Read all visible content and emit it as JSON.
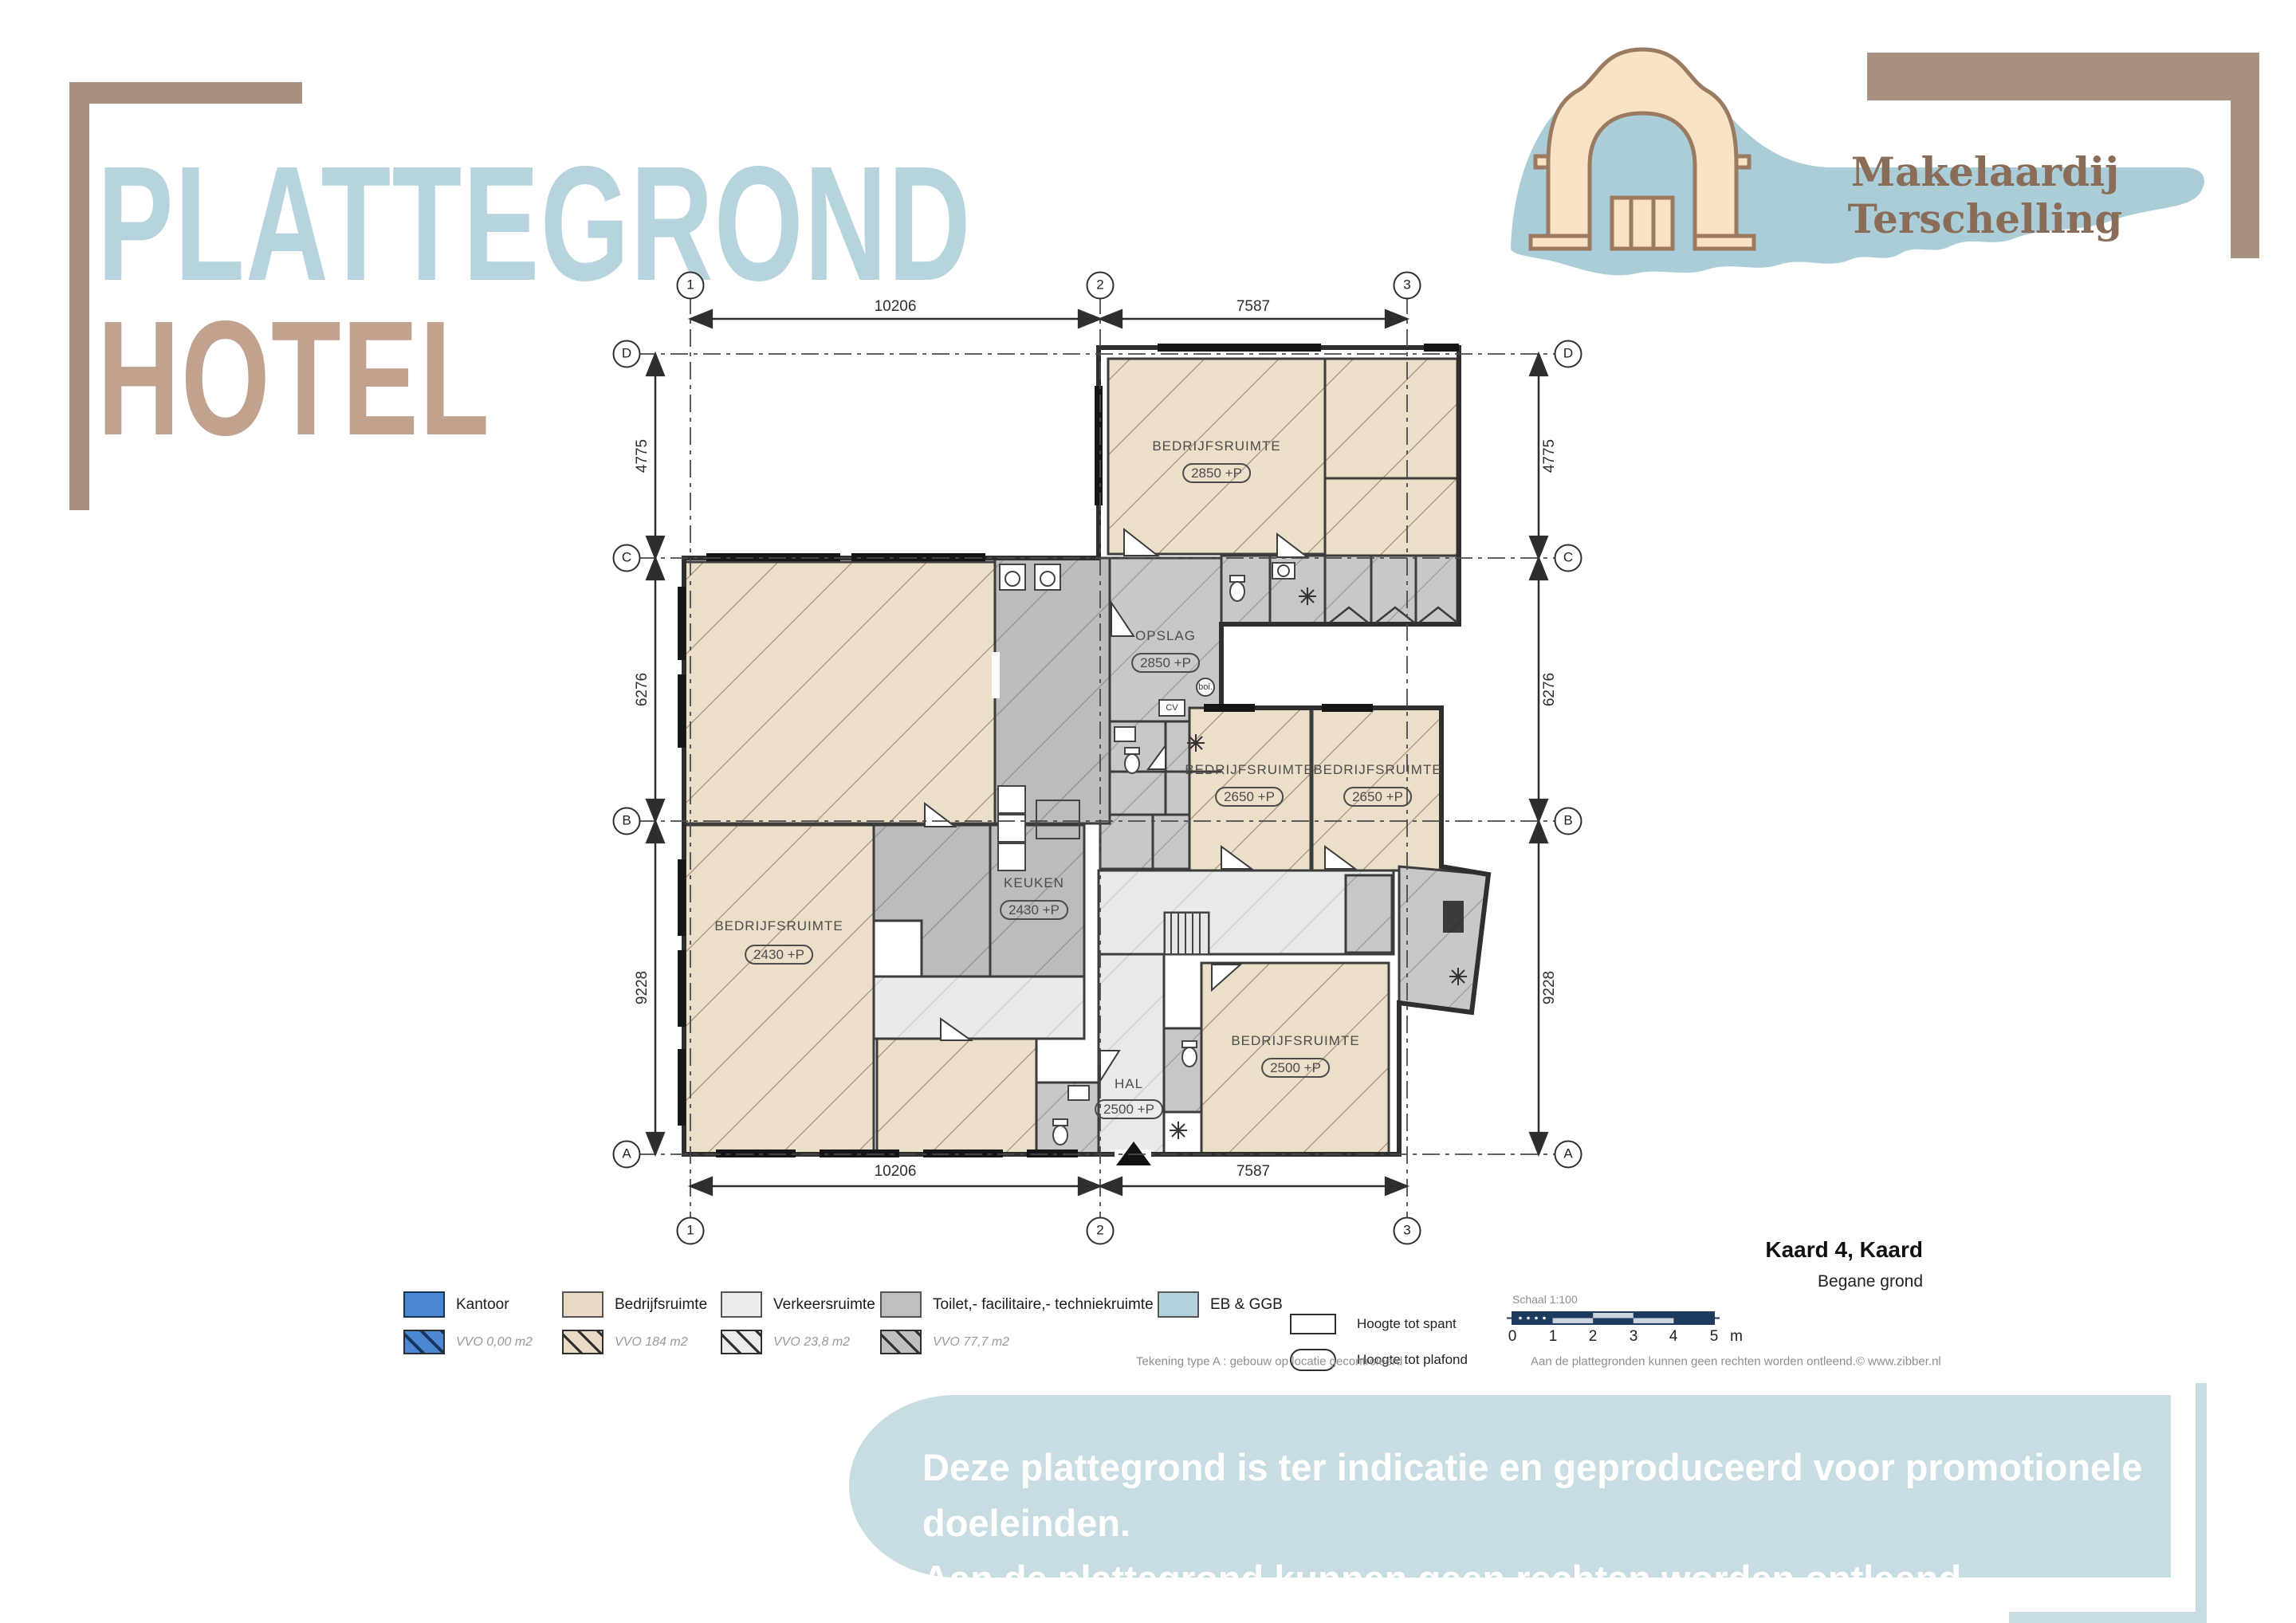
{
  "title": {
    "line1": "PLATTEGROND",
    "line2": "HOTEL"
  },
  "logo": {
    "name": "Makelaardij Terschelling"
  },
  "plan": {
    "grid": {
      "cols": [
        "1",
        "2",
        "3"
      ],
      "rows": [
        "D",
        "C",
        "B",
        "A"
      ]
    },
    "dims": {
      "top": [
        "10206",
        "7587"
      ],
      "bottom": [
        "10206",
        "7587"
      ],
      "left": [
        "4775",
        "6276",
        "9228"
      ],
      "right": [
        "4775",
        "6276",
        "9228"
      ]
    },
    "rooms": [
      {
        "name": "BEDRIJFSRUIMTE",
        "badge": "2850 +P"
      },
      {
        "name": "OPSLAG",
        "badge": "2850 +P"
      },
      {
        "name": "BEDRIJFSRUIMTE",
        "badge": "2650 +P"
      },
      {
        "name": "BEDRIJFSRUIMTE",
        "badge": "2650 +P"
      },
      {
        "name": "BEDRIJFSRUIMTE",
        "badge": "2430 +P"
      },
      {
        "name": "KEUKEN",
        "badge": "2430 +P"
      },
      {
        "name": "HAL",
        "badge": "2500 +P"
      },
      {
        "name": "BEDRIJFSRUIMTE",
        "badge": "2500 +P"
      }
    ],
    "fixtures": {
      "cv": "CV",
      "boiler": "boi."
    }
  },
  "legend": {
    "items": [
      {
        "label": "Kantoor",
        "vvo": "VVO 0,00 m2"
      },
      {
        "label": "Bedrijfsruimte",
        "vvo": "VVO 184 m2"
      },
      {
        "label": "Verkeersruimte",
        "vvo": "VVO 23,8 m2"
      },
      {
        "label": "Toilet,- facilitaire,- techniekruimte",
        "vvo": "VVO 77,7 m2"
      },
      {
        "label": "EB & GGB"
      }
    ]
  },
  "info": {
    "project": "Kaard 4, Kaard",
    "floor": "Begane grond",
    "height_spant": "Hoogte tot spant",
    "height_plafond": "Hoogte tot plafond",
    "scale_label": "Schaal 1:100",
    "scale_ticks": [
      "0",
      "1",
      "2",
      "3",
      "4",
      "5"
    ],
    "scale_unit": "m",
    "note_left": "Tekening type A : gebouw op locatie gecontroleerd",
    "note_right": "Aan de plattegronden kunnen geen rechten worden ontleend.© www.zibber.nl"
  },
  "banner": {
    "line1": "Deze plattegrond is ter indicatie en geproduceerd voor promotionele doeleinden.",
    "line2": "Aan de plattegrond kunnen geen rechten worden ontleend."
  },
  "colors": {
    "title_blue": "#b7d4de",
    "title_brown": "#c0a28e",
    "bracket_brown": "#a8917e",
    "banner_bg": "#c7dde3",
    "logo_text_brown": "#8a6d58",
    "logo_island_blue": "#abcdd8",
    "logo_arch_cream": "#f7e2c4",
    "kantoor_blue": "#4d86d2",
    "bedrijfsruimte_tan": "#e8dac4",
    "verkeersruimte_gray": "#ededed",
    "toilet_gray": "#bfbfbf",
    "eb_ggb_blue": "#b4d2dd",
    "scalebar_navy": "#1e3a5f"
  }
}
